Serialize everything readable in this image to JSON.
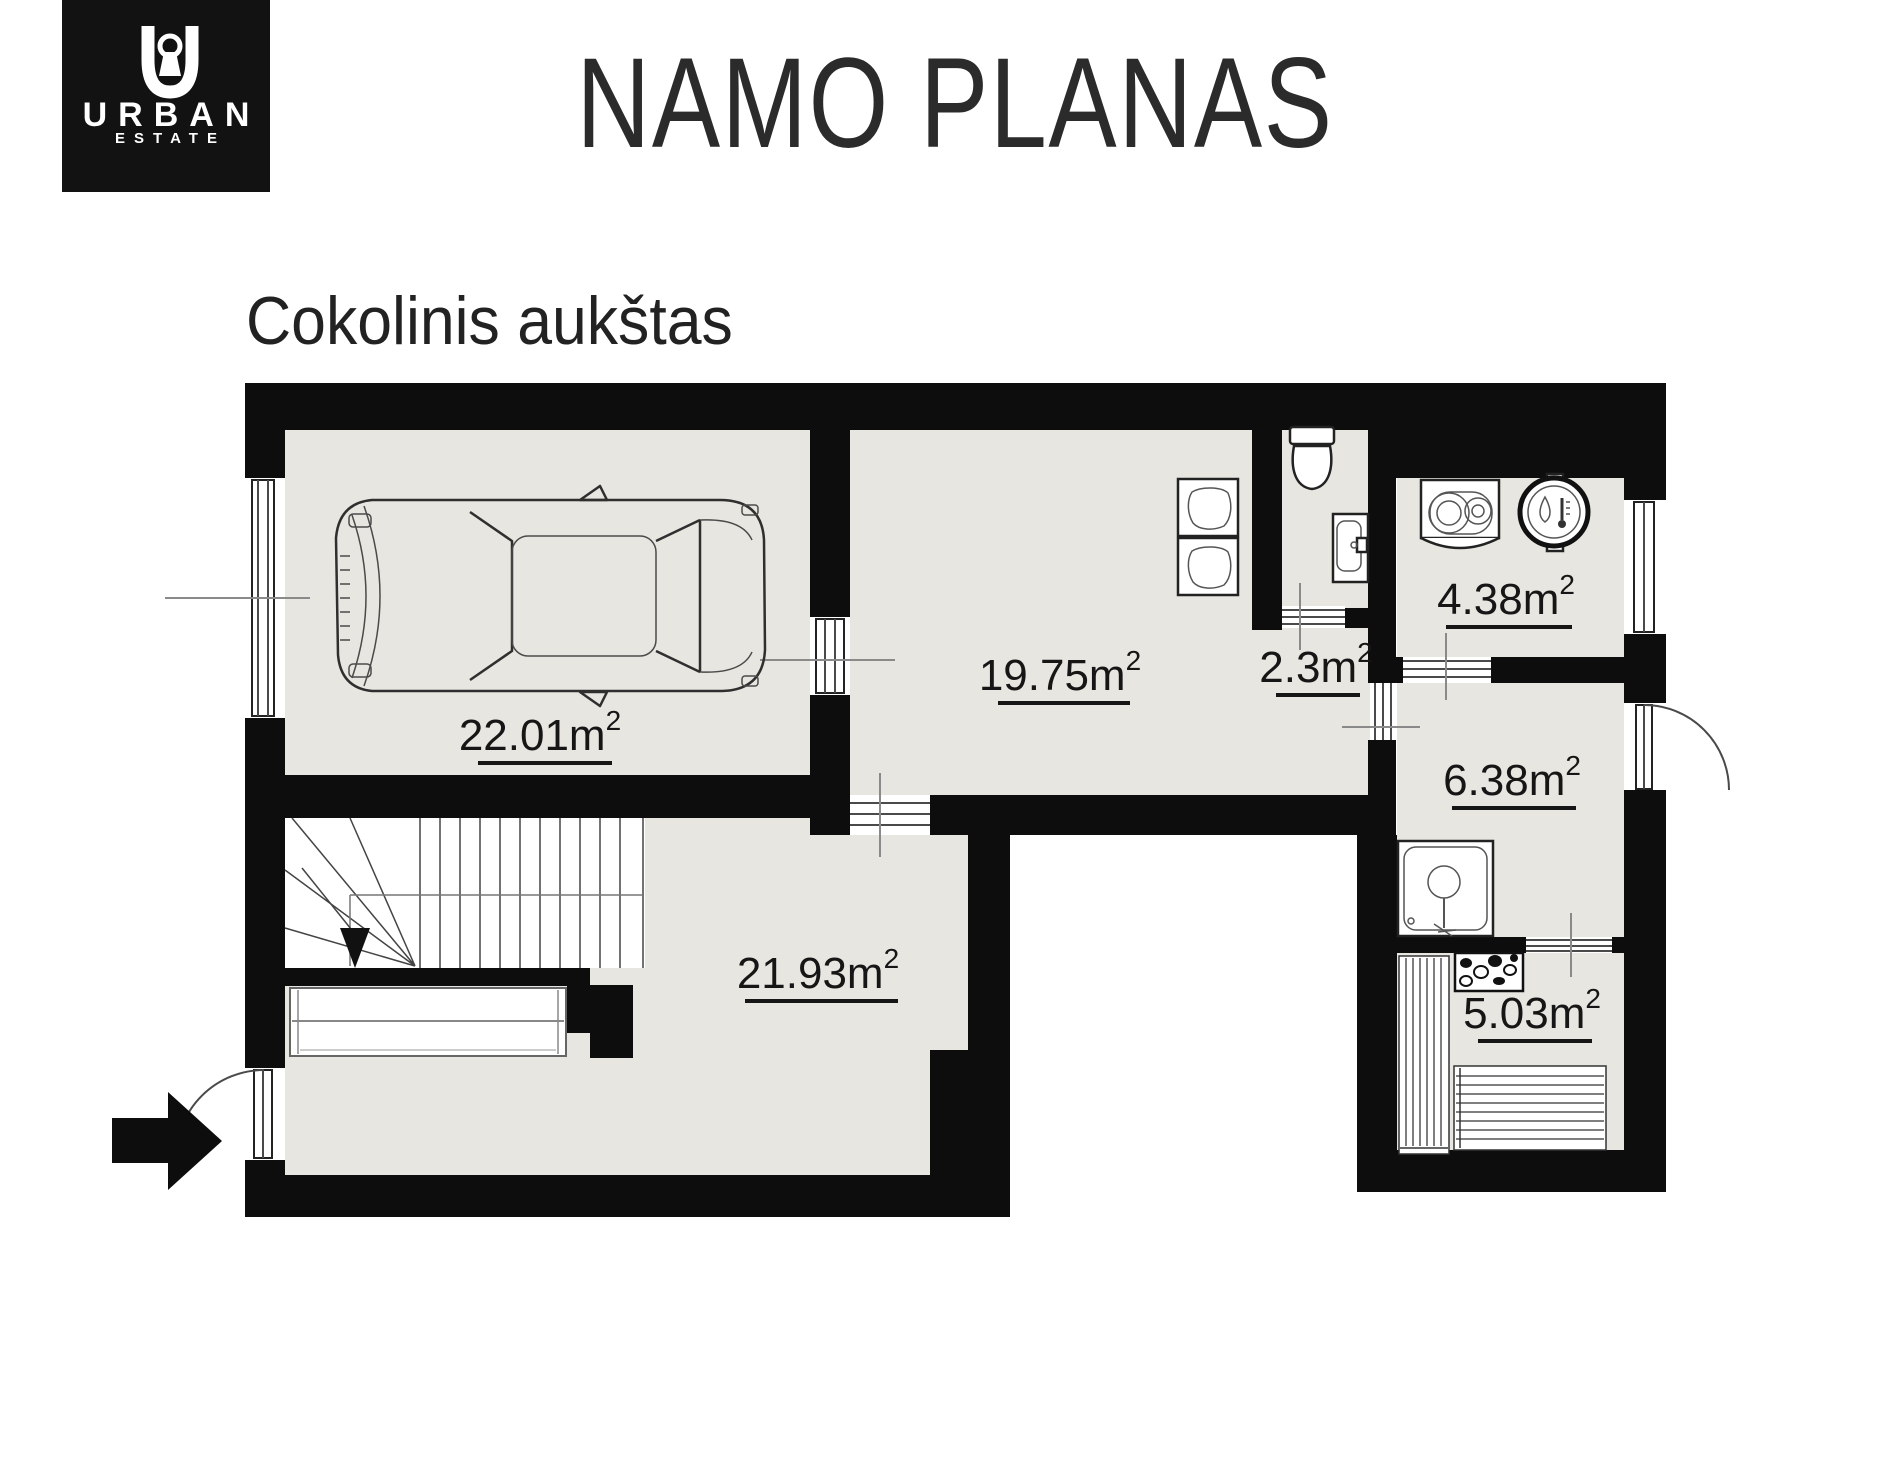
{
  "logo": {
    "brand": "URBAN",
    "subbrand": "ESTATE"
  },
  "header": {
    "title": "NAMO PLANAS"
  },
  "plan": {
    "floor_label": "Cokolinis aukštas",
    "rooms": [
      {
        "id": "garage",
        "area": "22.01m",
        "sup": "2"
      },
      {
        "id": "living-room",
        "area": "19.75m",
        "sup": "2"
      },
      {
        "id": "wc",
        "area": "2.3m",
        "sup": "2"
      },
      {
        "id": "bathroom",
        "area": "4.38m",
        "sup": "2"
      },
      {
        "id": "hallway",
        "area": "6.38m",
        "sup": "2"
      },
      {
        "id": "basement-room",
        "area": "21.93m",
        "sup": "2"
      },
      {
        "id": "sauna",
        "area": "5.03m",
        "sup": "2"
      }
    ],
    "icons": [
      "car-top-view",
      "stairs",
      "stairs-down-arrow",
      "wardrobe",
      "entrance-arrow",
      "door-swing",
      "window",
      "toilet",
      "washbasin",
      "armchairs",
      "washing-machine",
      "boiler",
      "shower",
      "sauna-bench",
      "sauna-stove"
    ],
    "colors": {
      "wall": "#0d0d0d",
      "floor": "#e8e6e0",
      "outside": "#ffffff"
    }
  }
}
